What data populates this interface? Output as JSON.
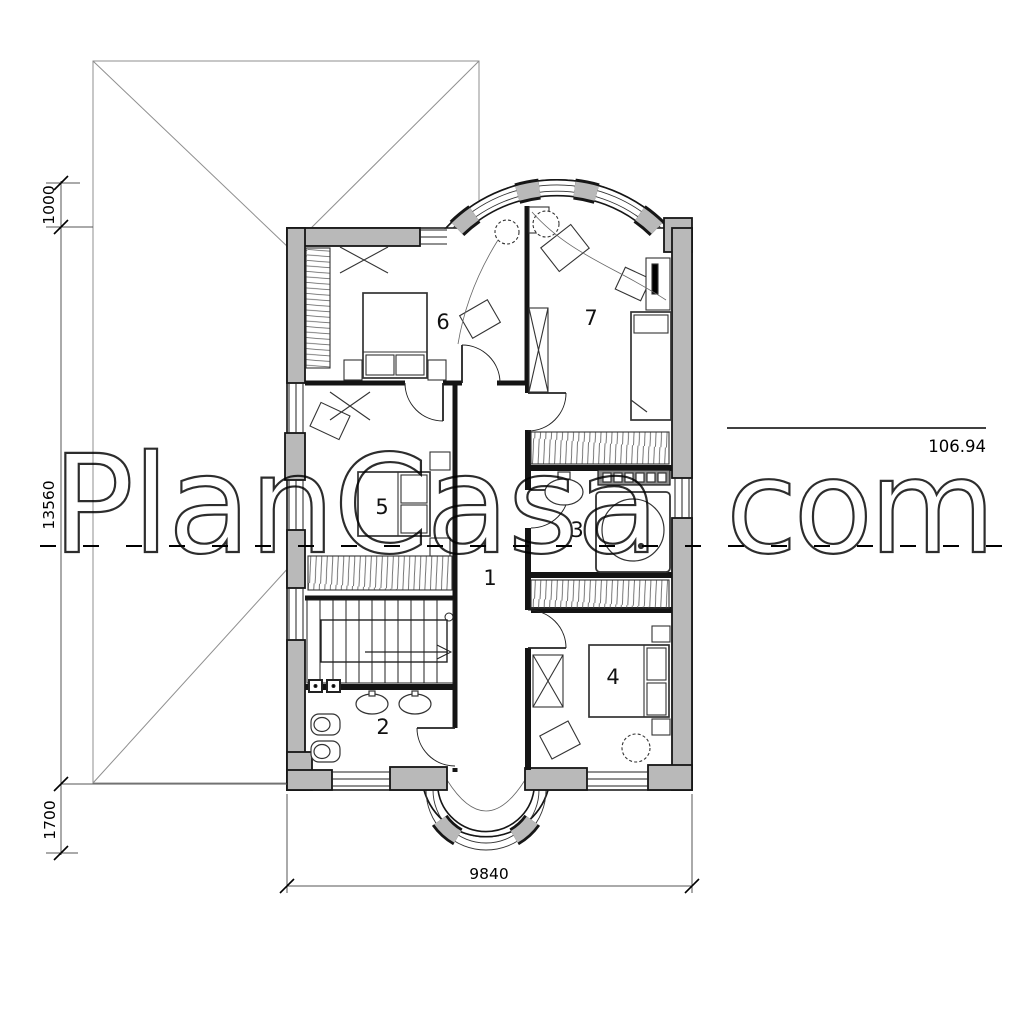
{
  "watermark": {
    "left": "PlanCasa",
    "right": "com"
  },
  "level_mark": {
    "value": "106.94"
  },
  "dimensions": {
    "roof_offset_top": "1000",
    "plan_height": "13560",
    "roof_offset_bottom": "1700",
    "plan_width": "9840"
  },
  "rooms": {
    "hall": "1",
    "wc": "2",
    "bathroom": "3",
    "bedroom_right": "4",
    "bedroom_left": "5",
    "bedroom_top": "6",
    "living_room": "7"
  }
}
